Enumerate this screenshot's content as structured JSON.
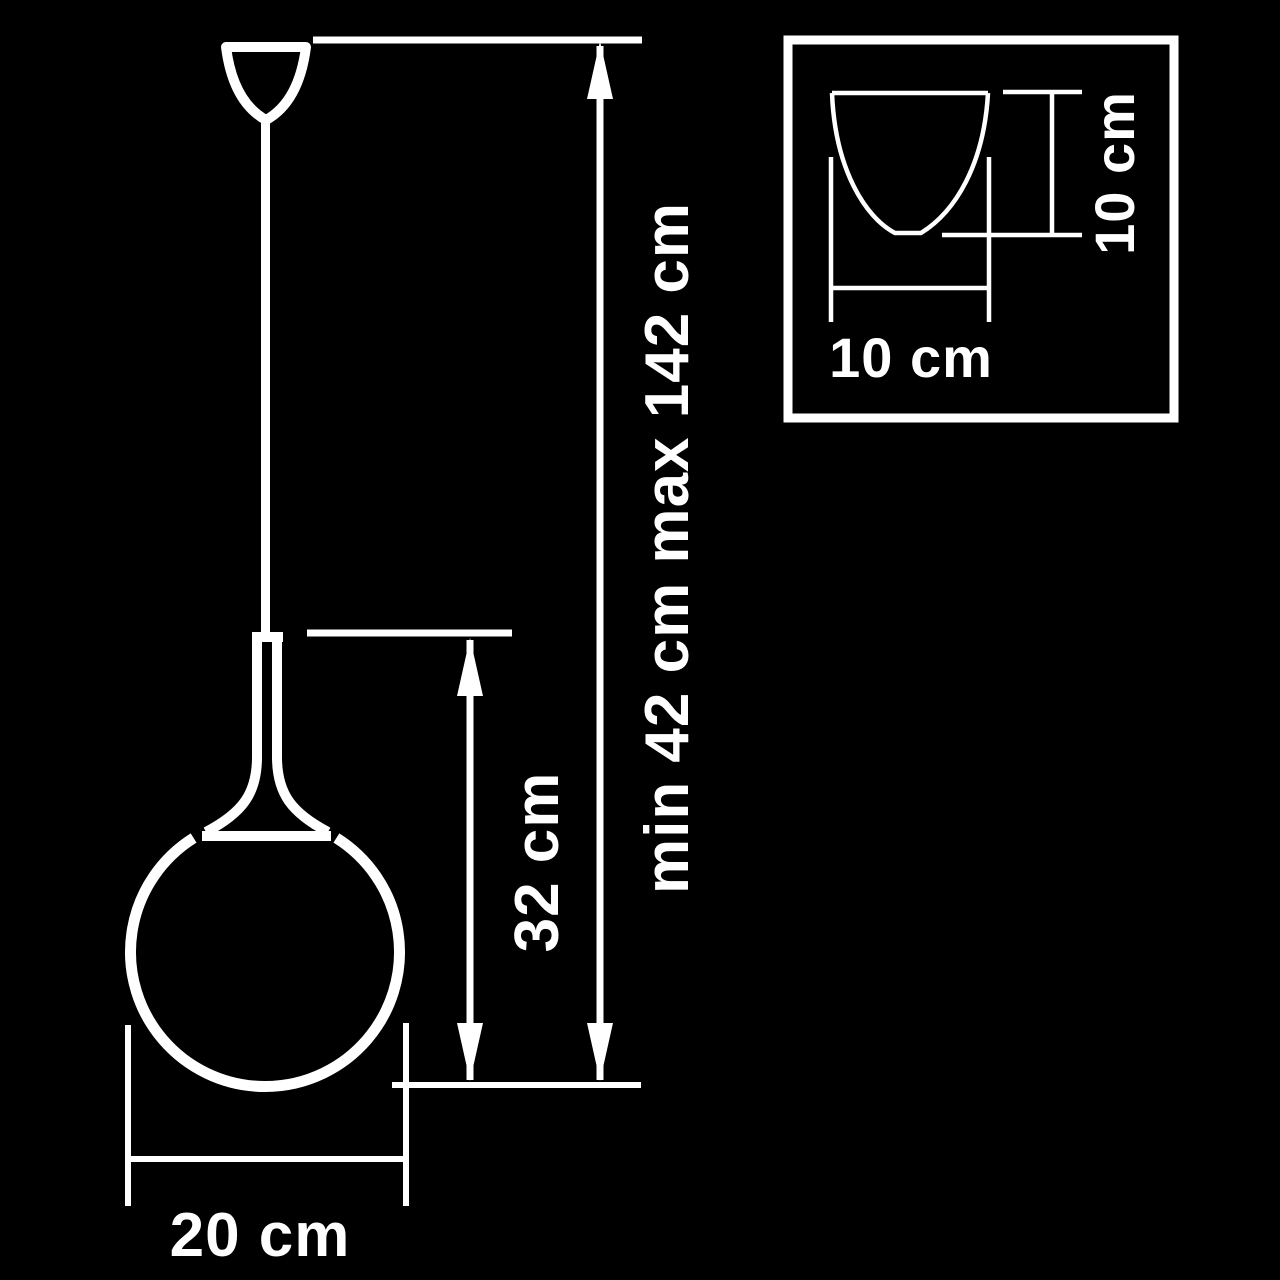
{
  "scene": {
    "background_color": "#000000",
    "line_color": "#ffffff",
    "description": "pendant-lamp-dimension-drawing"
  },
  "pendant_view": {
    "overall_height_label": "min 42 cm max 142 cm",
    "shade_height_label": "32 cm",
    "shade_diameter_label": "20 cm"
  },
  "inset_view": {
    "width_label": "10 cm",
    "height_label": "10 cm"
  }
}
